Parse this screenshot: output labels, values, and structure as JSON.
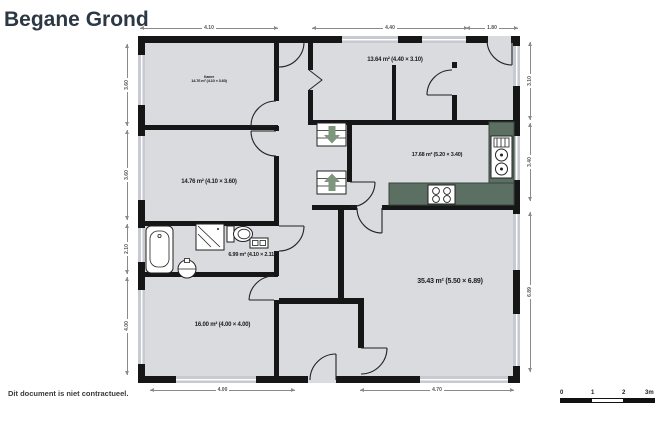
{
  "title": "Begane Grond",
  "footer_note": "Dit document is niet contractueel.",
  "rooms": {
    "top_left": {
      "name_small": "Kamer",
      "area": "14.76 m² (4.10 × 3.60)"
    },
    "mid_left": {
      "area": "14.76 m² (4.10 × 3.60)"
    },
    "bathroom": {
      "area": "6.99 m² (4.10 × 2.11)"
    },
    "bottom_left": {
      "area": "16.00 m² (4.00 × 4.00)"
    },
    "top_middle": {
      "area": "13.64 m² (4.40 × 3.10)"
    },
    "kitchen": {
      "area": "17.68 m² (5.20 × 3.40)"
    },
    "living": {
      "area": "35.43 m² (5.50 × 6.89)"
    }
  },
  "dimensions": {
    "top": [
      "4.10",
      "4.40",
      "1.80"
    ],
    "left": [
      "3.60",
      "3.60",
      "2.10",
      "4.00"
    ],
    "right": [
      "3.10",
      "3.40",
      "6.89"
    ],
    "bottom": [
      "4.00",
      "4.70"
    ]
  },
  "scale_bar": {
    "ticks": [
      "0",
      "1",
      "2",
      "3m"
    ]
  },
  "colors": {
    "floor": "#d9dbdf",
    "wall": "#161616",
    "window": "#c7cad0",
    "counter": "#5c6f63",
    "stair_arrow": "#7e967e",
    "title_text": "#2c3844"
  }
}
